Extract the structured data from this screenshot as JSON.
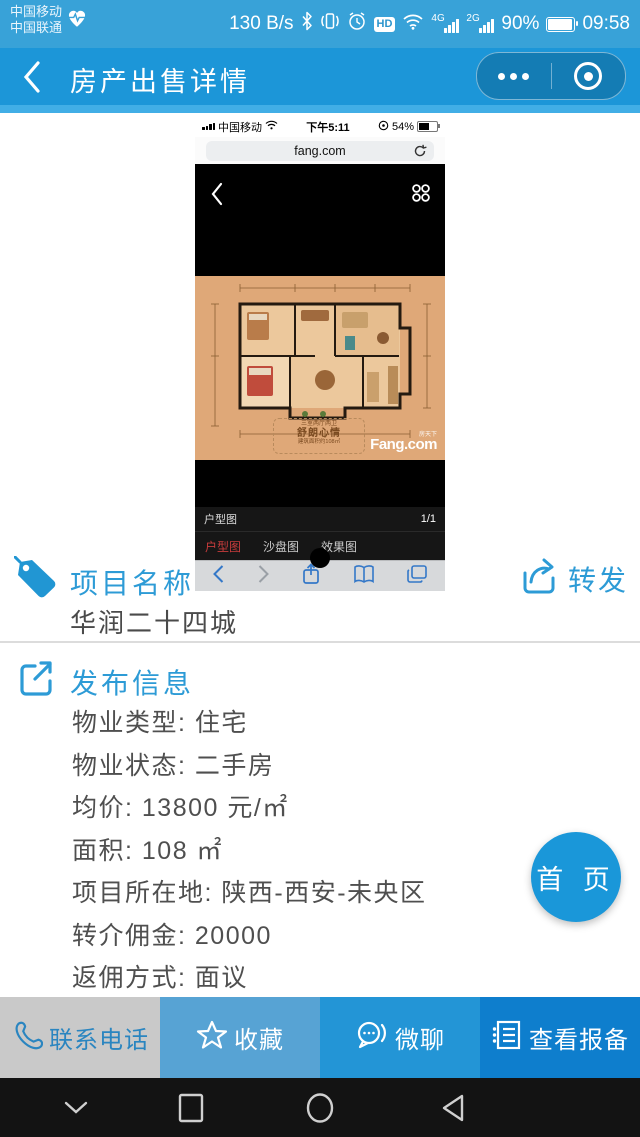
{
  "status_bar": {
    "carrier_line1": "中国移动",
    "carrier_line2": "中国联通",
    "net_speed": "130 B/s",
    "hd_label": "HD",
    "sig1_label": "4G",
    "sig2_label": "2G",
    "battery_percent": "90%",
    "time": "09:58"
  },
  "header": {
    "title": "房产出售详情"
  },
  "phone": {
    "status": {
      "carrier": "中国移动",
      "time": "下午5:11",
      "battery_percent": "54%"
    },
    "url": "fang.com",
    "viewer": {
      "caption": "户型图",
      "page_indicator": "1/1",
      "tabs": [
        {
          "label": "户型图",
          "active": true
        },
        {
          "label": "沙盘图",
          "active": false
        },
        {
          "label": "效果图",
          "active": false
        }
      ],
      "watermark": {
        "line1": "三室两厅两卫",
        "line2": "舒朗心情",
        "line3": "建筑面积约108㎡",
        "logo_small": "房天下",
        "logo": "Fang.com"
      }
    }
  },
  "project": {
    "title": "项目名称",
    "forward_label": "转发",
    "name": "华润二十四城"
  },
  "info": {
    "title": "发布信息",
    "rows": [
      "物业类型: 住宅",
      "物业状态: 二手房",
      "均价: 13800 元/㎡",
      "面积: 108 ㎡",
      "项目所在地: 陕西-西安-未央区",
      "转介佣金: 20000",
      "返佣方式: 面议"
    ]
  },
  "fab": {
    "label": "首 页",
    "bg": "#1a97d9"
  },
  "action_bar": {
    "buttons": [
      {
        "label": "联系电话",
        "bg": "#c9c9c9",
        "color": "#2a85c0"
      },
      {
        "label": "收藏",
        "bg": "#57a3d4",
        "color": "#ffffff"
      },
      {
        "label": "微聊",
        "bg": "#2395d6",
        "color": "#ffffff"
      },
      {
        "label": "查看报备",
        "bg": "#0e7ecd",
        "color": "#ffffff"
      }
    ]
  },
  "colors": {
    "status_bar_bg": "#38a2d8",
    "header_bg": "#1c96d8",
    "accent_blue": "#2d9bd6",
    "tab_active_red": "#c83c3c"
  }
}
